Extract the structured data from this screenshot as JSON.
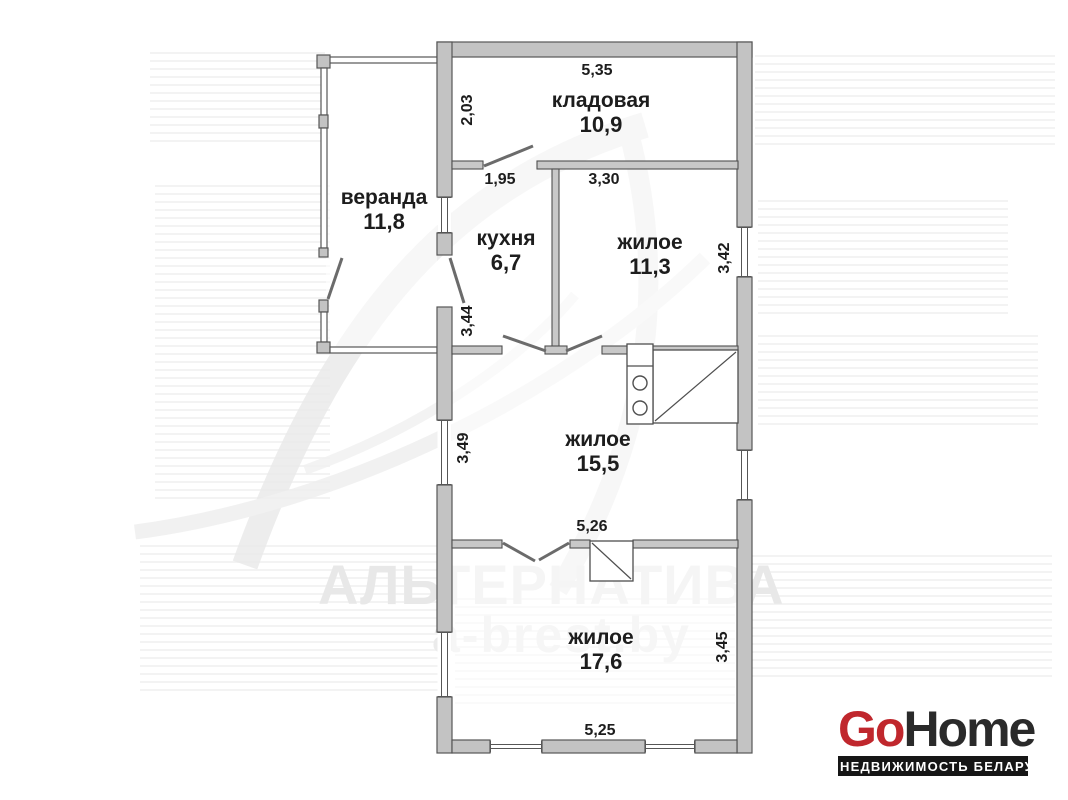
{
  "plan": {
    "rooms": [
      {
        "id": "kladovaya",
        "name": "кладовая",
        "area": "10,9"
      },
      {
        "id": "veranda",
        "name": "веранда",
        "area": "11,8"
      },
      {
        "id": "kukhnya",
        "name": "кухня",
        "area": "6,7"
      },
      {
        "id": "zhiloe-1",
        "name": "жилое",
        "area": "11,3"
      },
      {
        "id": "zhiloe-2",
        "name": "жилое",
        "area": "15,5"
      },
      {
        "id": "zhiloe-3",
        "name": "жилое",
        "area": "17,6"
      }
    ],
    "dimensions": {
      "kladovaya_width": "5,35",
      "kladovaya_depth": "2,03",
      "kukhnya_width": "1,95",
      "zhiloe1_width": "3,30",
      "zhiloe1_depth": "3,42",
      "kukhnya_depth": "3,44",
      "zhiloe2_depth": "3,49",
      "zhiloe2_width": "5,26",
      "zhiloe3_depth": "3,45",
      "zhiloe3_width": "5,25"
    }
  },
  "watermark": {
    "agency": "АЛЬТЕРНАТИВА",
    "website": "a-brest.by"
  },
  "logo": {
    "brand_part1": "Go",
    "brand_part2": "Home",
    "tagline": "НЕДВИЖИМОСТЬ БЕЛАРУСИ",
    "accent_color": "#c0272d",
    "dark_color": "#2a2a2a",
    "wall_color": "#c3c3c3"
  }
}
